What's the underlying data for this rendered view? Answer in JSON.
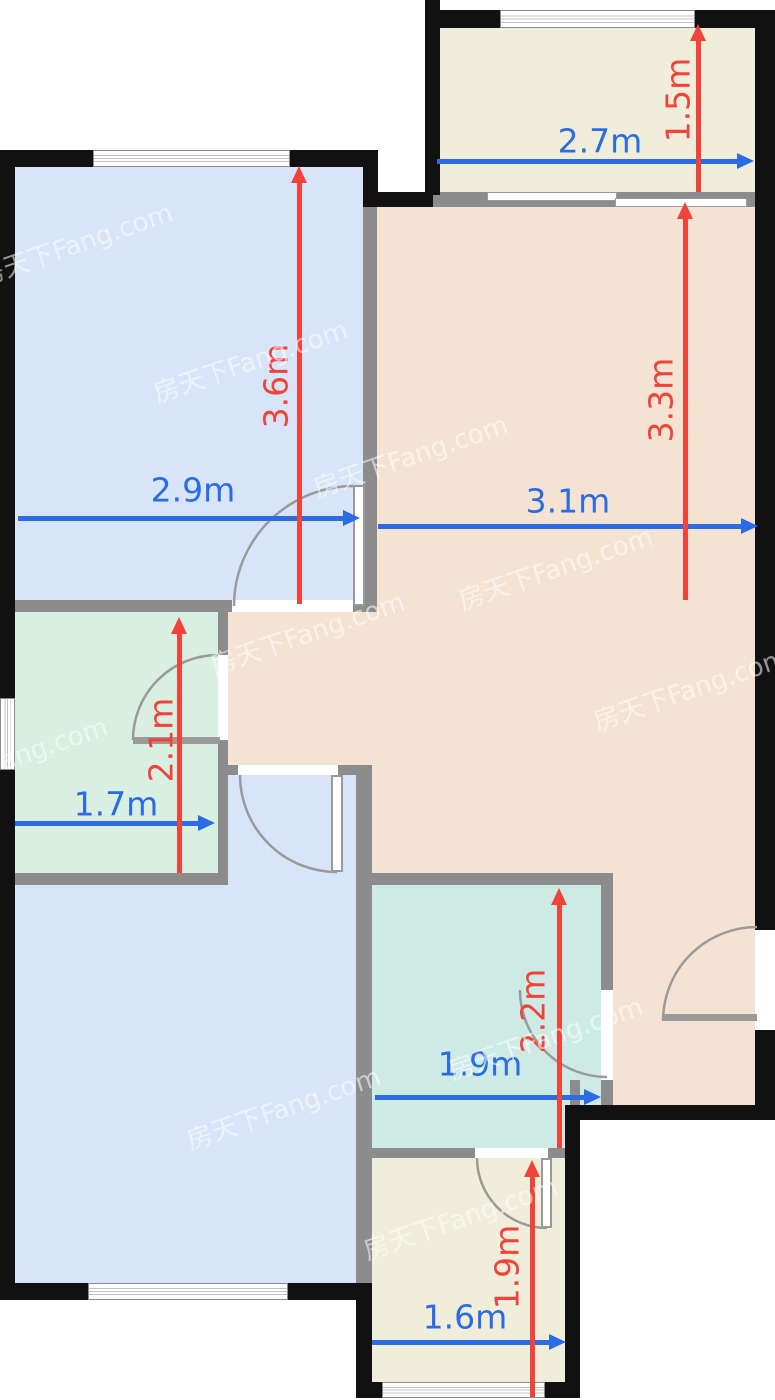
{
  "plan": {
    "watermark_text": "房天下Fang.com",
    "colors": {
      "dim_horizontal_arrow": "#2b6ce4",
      "dim_vertical_arrow": "#f2433b",
      "wall_exterior": "#111111",
      "wall_interior": "#8c8c8c"
    },
    "room_fills": {
      "bedroom_top_left": "#d8e4f8",
      "bedroom_bottom_left": "#d8e4f8",
      "living_dining": "#f4e3d3",
      "bathroom": "#d8efe2",
      "kitchen": "#cdeae5",
      "balcony_top": "#f0eeda",
      "balcony_bottom": "#f0eeda"
    },
    "dimensions": {
      "bedroom_top_width": "2.9m",
      "bedroom_top_height": "3.6m",
      "balcony_top_width": "2.7m",
      "balcony_top_height": "1.5m",
      "living_width": "3.1m",
      "living_height": "3.3m",
      "bathroom_width": "1.7m",
      "bathroom_height": "2.1m",
      "kitchen_width": "1.9m",
      "kitchen_height": "2.2m",
      "balcony_bottom_width": "1.6m",
      "balcony_bottom_height": "1.9m"
    }
  }
}
